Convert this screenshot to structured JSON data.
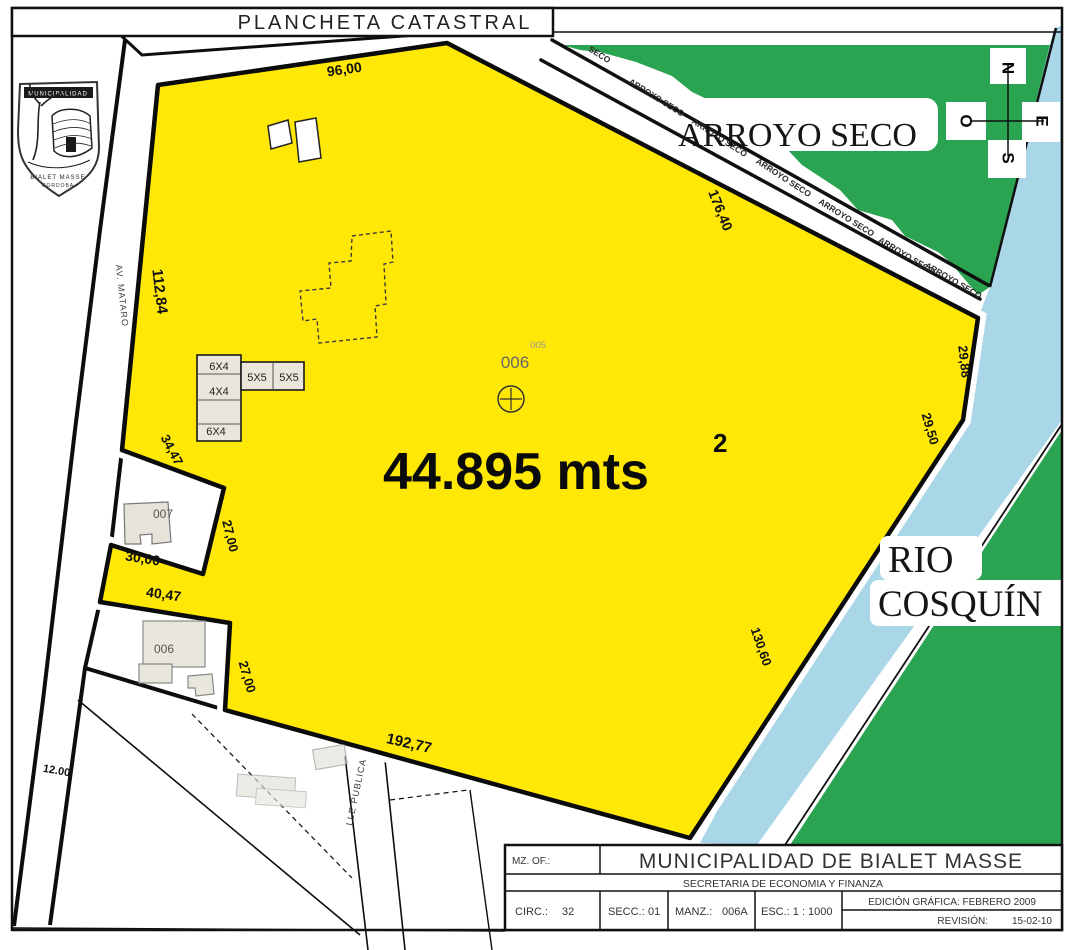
{
  "header": {
    "title": "PLANCHETA CATASTRAL"
  },
  "logo": {
    "top_text": "MUNICIPALIDAD",
    "name": "BIALET MASSE",
    "sub": "CORDOBA"
  },
  "compass": {
    "n": "N",
    "s": "S",
    "e": "E",
    "o": "O"
  },
  "features": {
    "arroyo": "ARROYO SECO",
    "arroyo_small": "ARROYO SECO",
    "arroyo_small_short": "SECO",
    "rio_line1": "RIO",
    "rio_line2": "COSQUÍN"
  },
  "streets": {
    "av_mataro": "AV. MATARO",
    "calle_publica": "LLE PUBLICA",
    "width_label": "12.00"
  },
  "main_parcel": {
    "number": "006",
    "neighbor_number": "005",
    "area": "44.895 mts",
    "area_exponent": "2",
    "dim_top": "96,00",
    "dim_left": "112,84",
    "dim_upper_right": "176,40",
    "dim_right_1": "29,88",
    "dim_right_2": "29,50",
    "dim_right_3": "130,60",
    "dim_bottom": "192,77"
  },
  "parcel_007": {
    "number": "007",
    "dim_top": "34,47",
    "dim_right": "27,00",
    "dim_bottom": "30,00"
  },
  "parcel_006": {
    "number": "006",
    "dim_top": "40,47",
    "dim_right": "27,00"
  },
  "buildings": {
    "rooms": [
      "6X4",
      "5X5",
      "5X5",
      "4X4",
      "6X4"
    ]
  },
  "title_block": {
    "mz_label": "MZ. OF.:",
    "municipality": "MUNICIPALIDAD DE BIALET MASSE",
    "secretary": "SECRETARIA DE ECONOMIA Y FINANZA",
    "circ_label": "CIRC.:",
    "circ_value": "32",
    "secc_label": "SECC.:",
    "secc_value": "01",
    "manz_label": "MANZ.:",
    "manz_value": "006A",
    "esc_label": "ESC.: 1 :",
    "esc_value": "1000",
    "edition": "EDICIÓN GRÁFICA: FEBRERO 2009",
    "revision_label": "REVISIÓN:",
    "revision_value": "15-02-10"
  },
  "colors": {
    "parcel_yellow": "#FFE806",
    "vegetation_green": "#2BA452",
    "river_blue": "#A9D7E8"
  }
}
